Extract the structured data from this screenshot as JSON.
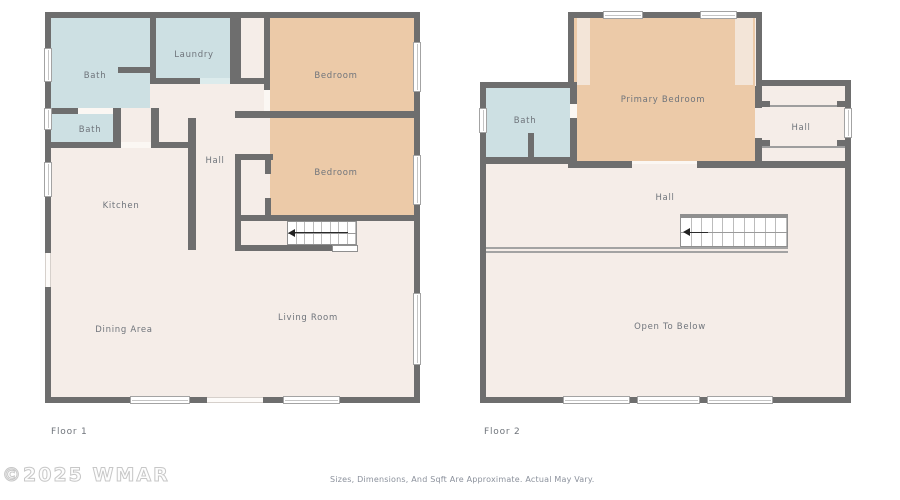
{
  "floor1": {
    "label": "Floor 1",
    "rooms": {
      "bath_top": "Bath",
      "laundry": "Laundry",
      "bedroom_top": "Bedroom",
      "bath_small": "Bath",
      "hall": "Hall",
      "kitchen": "Kitchen",
      "bedroom_mid": "Bedroom",
      "dining_area": "Dining Area",
      "living_room": "Living Room"
    }
  },
  "floor2": {
    "label": "Floor 2",
    "rooms": {
      "bath": "Bath",
      "primary_bedroom": "Primary Bedroom",
      "hall_upper": "Hall",
      "hall": "Hall",
      "open_to_below": "Open To Below"
    }
  },
  "footer": {
    "watermark": "©2025 WMAR",
    "disclaimer": "Sizes, Dimensions, And Sqft Are Approximate. Actual May Vary."
  },
  "colors": {
    "wall": "#6e6e6e",
    "floor": "#f5ede8",
    "bath": "#cde0e3",
    "bedroom": "#eccaa8",
    "stair_outline": "#8f8f8f",
    "label_text": "#6f747b",
    "watermark": "#c7c7c7",
    "disclaimer_text": "#8b919c"
  }
}
